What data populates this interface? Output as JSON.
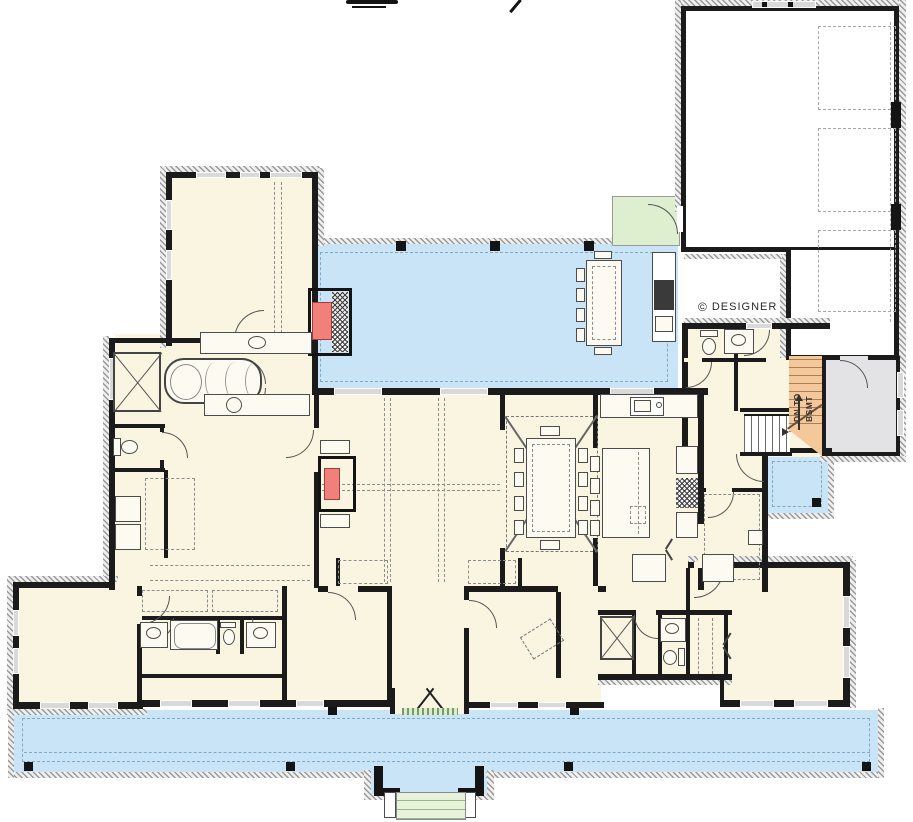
{
  "annotations": {
    "credit_symbol": "©",
    "credit_text": "DESIGNER",
    "basement_stair_label_line1": "DN TO",
    "basement_stair_label_line2": "BSMT"
  },
  "palette": {
    "interior-cream": "#f9f5e1",
    "porch-blue": "#c9e4f6",
    "stoop-green": "#ddefcf",
    "steps-green": "#e7f2db",
    "stair-orange": "#f5c89b",
    "fireplace-red": "#f1807a",
    "storage-gray": "#e3e3e6",
    "wall-black": "#1b1b1b"
  }
}
